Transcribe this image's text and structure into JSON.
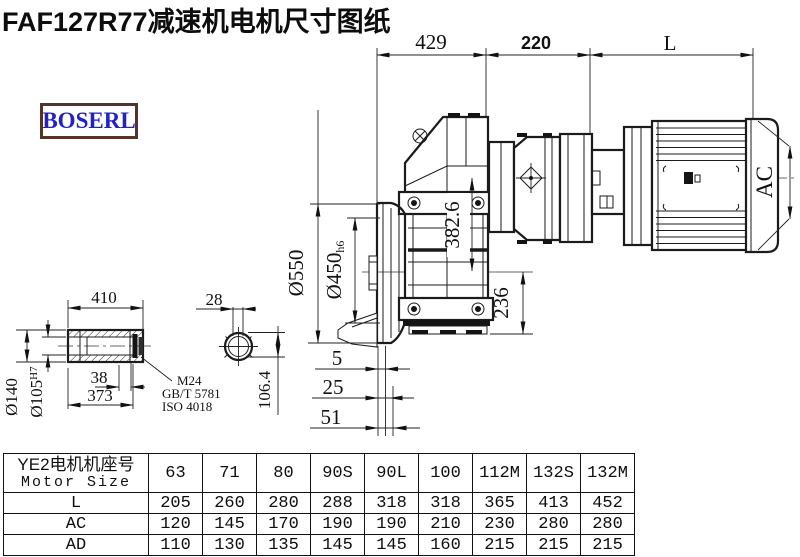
{
  "title": "FAF127R77减速机电机尺寸图纸",
  "logo_text": "BOSERL",
  "drawing": {
    "dims": {
      "top_429": "429",
      "top_220": "220",
      "top_L": "L",
      "ac": "AC",
      "d550": "Ø550",
      "d450": "Ø450",
      "d450_tol": "h6",
      "v382": "382.6",
      "v236": "236",
      "off5": "5",
      "off25": "25",
      "off51": "51",
      "shaft_410": "410",
      "shaft_38": "38",
      "shaft_373": "373",
      "d140": "Ø140",
      "d105": "Ø105",
      "d105_tol": "H7",
      "sec_28": "28",
      "sec_106": "106.4",
      "note_m24": "M24",
      "note_gbt": "GB/T 5781",
      "note_iso": "ISO 4018"
    }
  },
  "table": {
    "header_cn": "YE2电机机座号",
    "header_en": "Motor Size",
    "columns": [
      "63",
      "71",
      "80",
      "90S",
      "90L",
      "100",
      "112M",
      "132S",
      "132M"
    ],
    "rows": [
      {
        "label": "L",
        "values": [
          "205",
          "260",
          "280",
          "288",
          "318",
          "318",
          "365",
          "413",
          "452"
        ]
      },
      {
        "label": "AC",
        "values": [
          "120",
          "145",
          "170",
          "190",
          "190",
          "210",
          "230",
          "280",
          "280"
        ]
      },
      {
        "label": "AD",
        "values": [
          "110",
          "130",
          "135",
          "145",
          "145",
          "160",
          "215",
          "215",
          "215"
        ]
      }
    ]
  }
}
